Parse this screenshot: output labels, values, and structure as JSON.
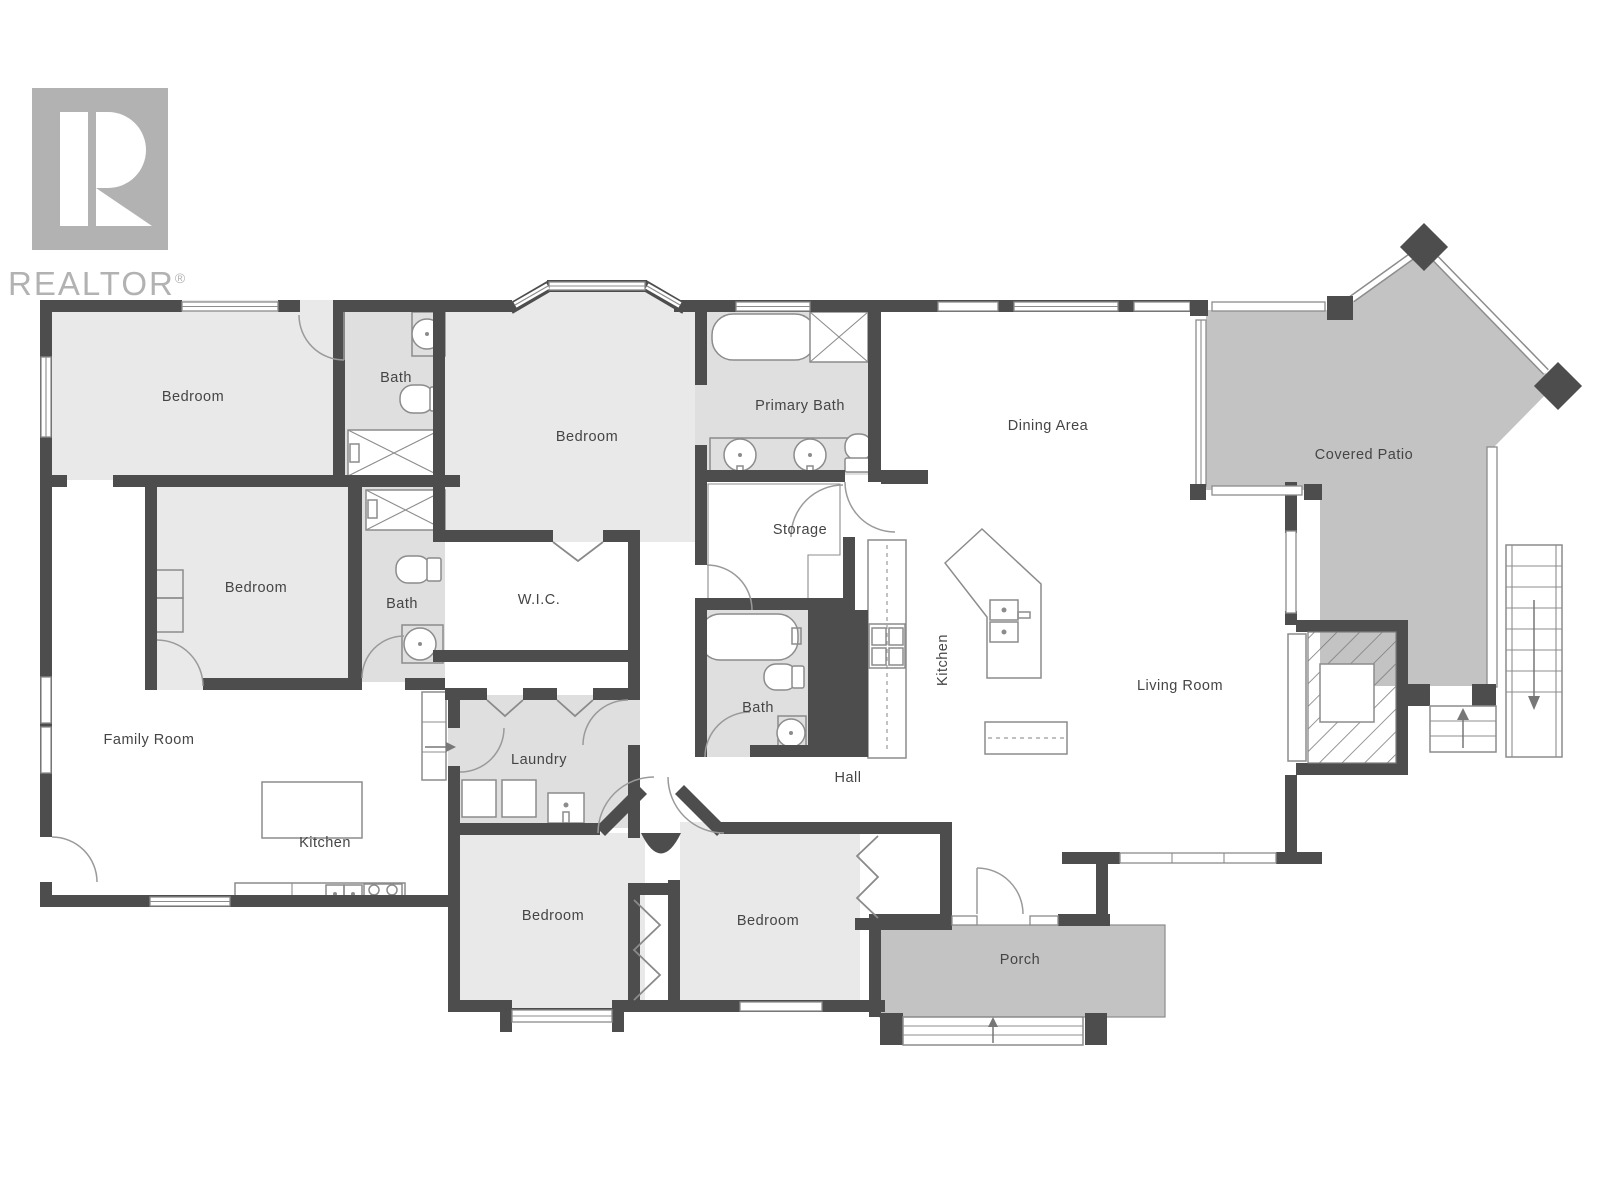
{
  "brand": {
    "logo_letter": "R",
    "wordmark": "REALTOR",
    "registered": "®"
  },
  "labels": {
    "bedroom_top_left": "Bedroom",
    "bath_top": "Bath",
    "bedroom_center": "Bedroom",
    "primary_bath": "Primary Bath",
    "dining_area": "Dining Area",
    "covered_patio": "Covered Patio",
    "bedroom_mid_left": "Bedroom",
    "bath_mid_left": "Bath",
    "wic": "W.I.C.",
    "storage": "Storage",
    "kitchen_main": "Kitchen",
    "living_room": "Living Room",
    "family_room": "Family Room",
    "laundry": "Laundry",
    "bath_hall": "Bath",
    "hall": "Hall",
    "kitchen_family": "Kitchen",
    "bedroom_bottom_left": "Bedroom",
    "bedroom_bottom_right": "Bedroom",
    "porch": "Porch"
  },
  "colors": {
    "wall": "#4d4d4d",
    "room_light": "#e9e9e9",
    "room_bath": "#dfdfdf",
    "outdoor": "#c3c3c3",
    "fixture_line": "#8c8c8c",
    "label_text": "#454545",
    "logo_gray": "#b2b2b2"
  }
}
